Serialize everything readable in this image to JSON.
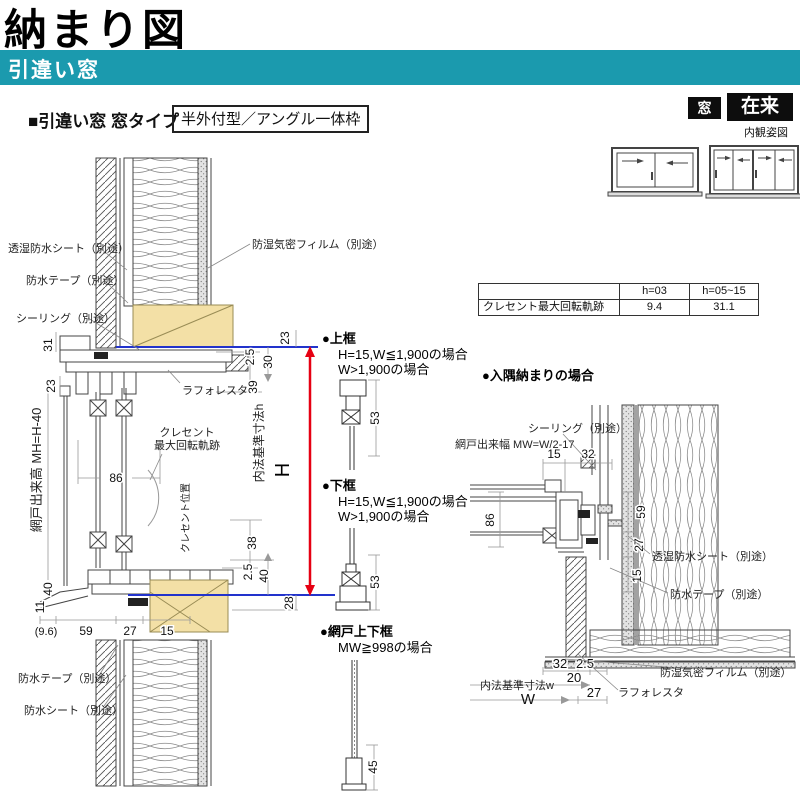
{
  "header": {
    "title": "納まり図",
    "band": "引違い窓",
    "section_heading": "■引違い窓 窓タイプ",
    "frame_type": "半外付型／アングル一体枠",
    "badge_mado": "窓",
    "badge_zairai": "在来",
    "view_caption": "内観姿図"
  },
  "spec_table": {
    "c1": "h=03",
    "c2": "h=05~15",
    "row_label": "クレセント最大回転軌跡",
    "v1": "9.4",
    "v2": "31.1"
  },
  "main": {
    "co_sheet": "透湿防水シート（別途）",
    "co_tape": "防水テープ（別途）",
    "co_seal": "シーリング（別途）",
    "co_film": "防湿気密フィルム（別途）",
    "co_laforesta": "ラフォレスタ",
    "co_crescent1": "クレセント",
    "co_crescent2": "最大回転軌跡",
    "co_crescent_pos": "クレセント位置",
    "co_naiho": "内法基準寸法h",
    "co_H": "H",
    "co_screen": "網戸出来高 MH=H-40",
    "co_tape_b": "防水テープ（別途）",
    "co_sheet_b": "防水シート（別途）",
    "d31": "31",
    "d23l": "23",
    "d23r": "23",
    "d25t": "2.5",
    "d30": "30",
    "d39": "39",
    "d86": "86",
    "d38": "38",
    "d25b": "2.5",
    "d40r": "40",
    "d28": "28",
    "d40l": "40",
    "d11": "11",
    "d96": "(9.6)",
    "d59": "59",
    "d27": "27",
    "d15": "15"
  },
  "details": {
    "u_head": "●上框",
    "u_c1": "H=15,W≦1,900の場合",
    "u_c2": "W>1,900の場合",
    "u_d": "53",
    "l_head": "●下框",
    "l_c1": "H=15,W≦1,900の場合",
    "l_c2": "W>1,900の場合",
    "l_d": "53",
    "s_head": "●網戸上下框",
    "s_c1": "MW≧998の場合",
    "s_d": "45"
  },
  "corner": {
    "heading": "●入隅納まりの場合",
    "co_seal": "シーリング（別途）",
    "co_screen_w": "網戸出来幅 MW=W/2-17",
    "co_sheet": "透湿防水シート（別途）",
    "co_tape": "防水テープ（別途）",
    "co_film": "防湿気密フィルム（別途）",
    "co_laforesta": "ラフォレスタ",
    "co_naiho": "内法基準寸法w",
    "co_W": "W",
    "d15t": "15",
    "d32t": "32",
    "d86": "86",
    "d59": "59",
    "d27v": "27",
    "d15v": "15",
    "d32b": "32",
    "d25": "2.5",
    "d20": "20",
    "d27b": "27"
  },
  "colors": {
    "accent_teal": "#1B9AAE",
    "dim_red": "#E60012",
    "ref_blue": "#2233CC",
    "wood_tan": "#F3E0A6"
  }
}
